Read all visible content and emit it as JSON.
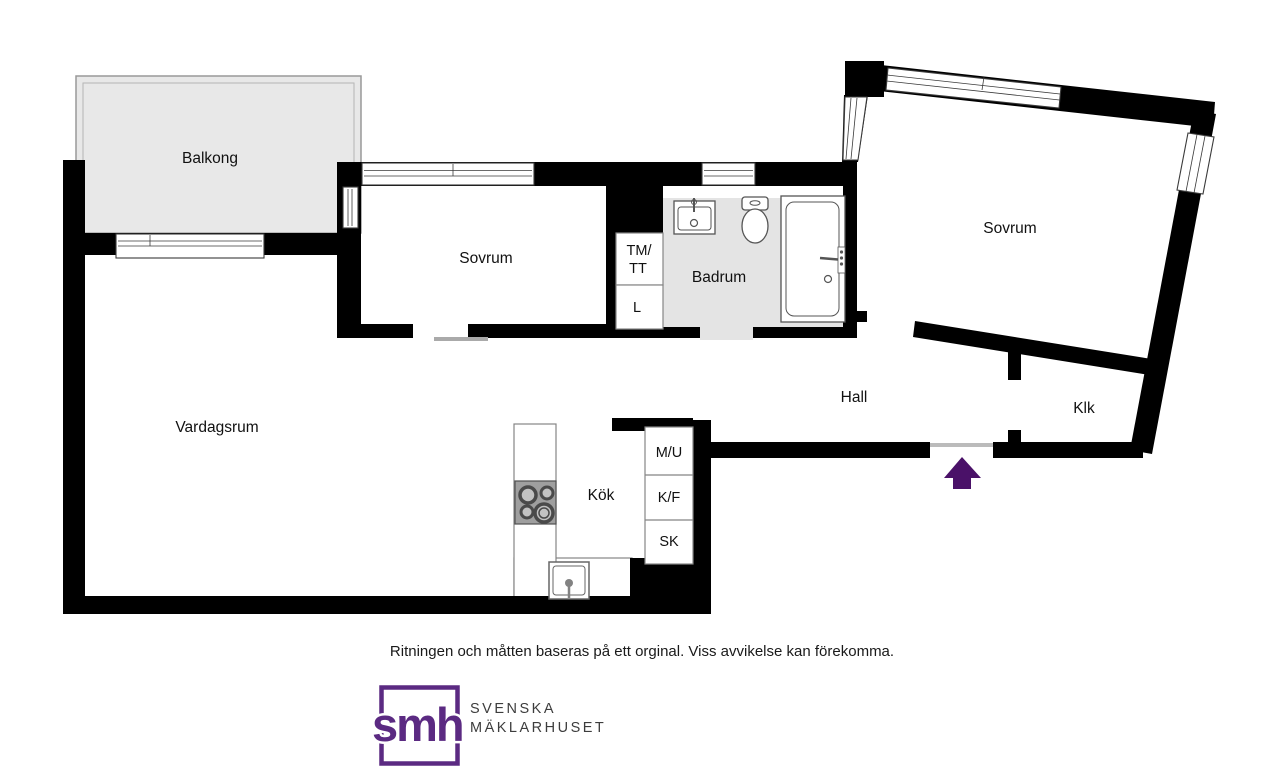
{
  "floorplan": {
    "rooms": {
      "balcony": "Balkong",
      "bedroom_left": "Sovrum",
      "bedroom_right": "Sovrum",
      "bathroom": "Badrum",
      "living_room": "Vardagsrum",
      "hall": "Hall",
      "kitchen": "Kök",
      "walkin_closet": "Klk"
    },
    "closets": {
      "tm_tt_line1": "TM/",
      "tm_tt_line2": "TT",
      "linen": "L"
    },
    "kitchen_units": {
      "mu": "M/U",
      "kf": "K/F",
      "sk": "SK"
    },
    "colors": {
      "wall": "#000000",
      "bathroom_floor": "#e4e4e4",
      "balcony_floor": "#e8e8e8",
      "stove_fill": "#9f9f9f",
      "fixture_stroke": "#555555",
      "entrance_arrow": "#4a1168",
      "logo_purple": "#5b2a82",
      "logo_text": "#3d3d3d"
    }
  },
  "footer": {
    "disclaimer": "Ritningen och måtten baseras på ett orginal. Viss avvikelse kan förekomma."
  },
  "logo": {
    "monogram": "smh",
    "name_line1": "SVENSKA",
    "name_line2": "MÄKLARHUSET"
  }
}
